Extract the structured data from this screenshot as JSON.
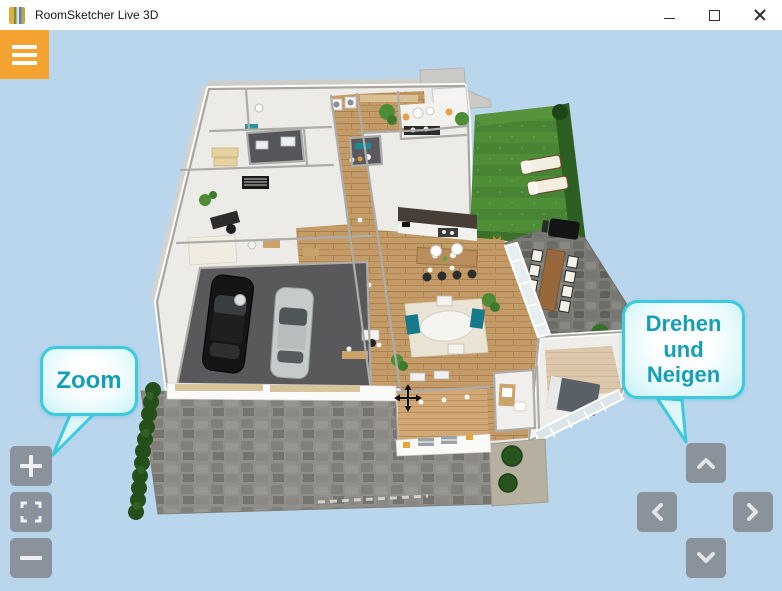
{
  "window": {
    "title": "RoomSketcher Live 3D",
    "controls": {
      "minimize": "minimize",
      "maximize": "maximize",
      "close": "close"
    }
  },
  "toolbar": {
    "menu_icon": "hamburger-menu-icon"
  },
  "callouts": {
    "zoom": {
      "text": "Zoom"
    },
    "rotate": {
      "line1": "Drehen",
      "line2": "und",
      "line3": "Neigen"
    }
  },
  "zoom_controls": {
    "zoom_in_icon": "plus-icon",
    "fullscreen_icon": "fullscreen-icon",
    "zoom_out_icon": "minus-icon"
  },
  "rotate_controls": {
    "up_icon": "chevron-up-icon",
    "left_icon": "chevron-left-icon",
    "right_icon": "chevron-right-icon",
    "down_icon": "chevron-down-icon"
  },
  "scene": {
    "view": "3D floor plan",
    "cursor": "move-crosshair"
  },
  "colors": {
    "background": "#BAD6EC",
    "accent_orange": "#F4A331",
    "bubble_border": "#3CCBDD",
    "bubble_text": "#149FB8",
    "control_gray": "#858B8F"
  }
}
